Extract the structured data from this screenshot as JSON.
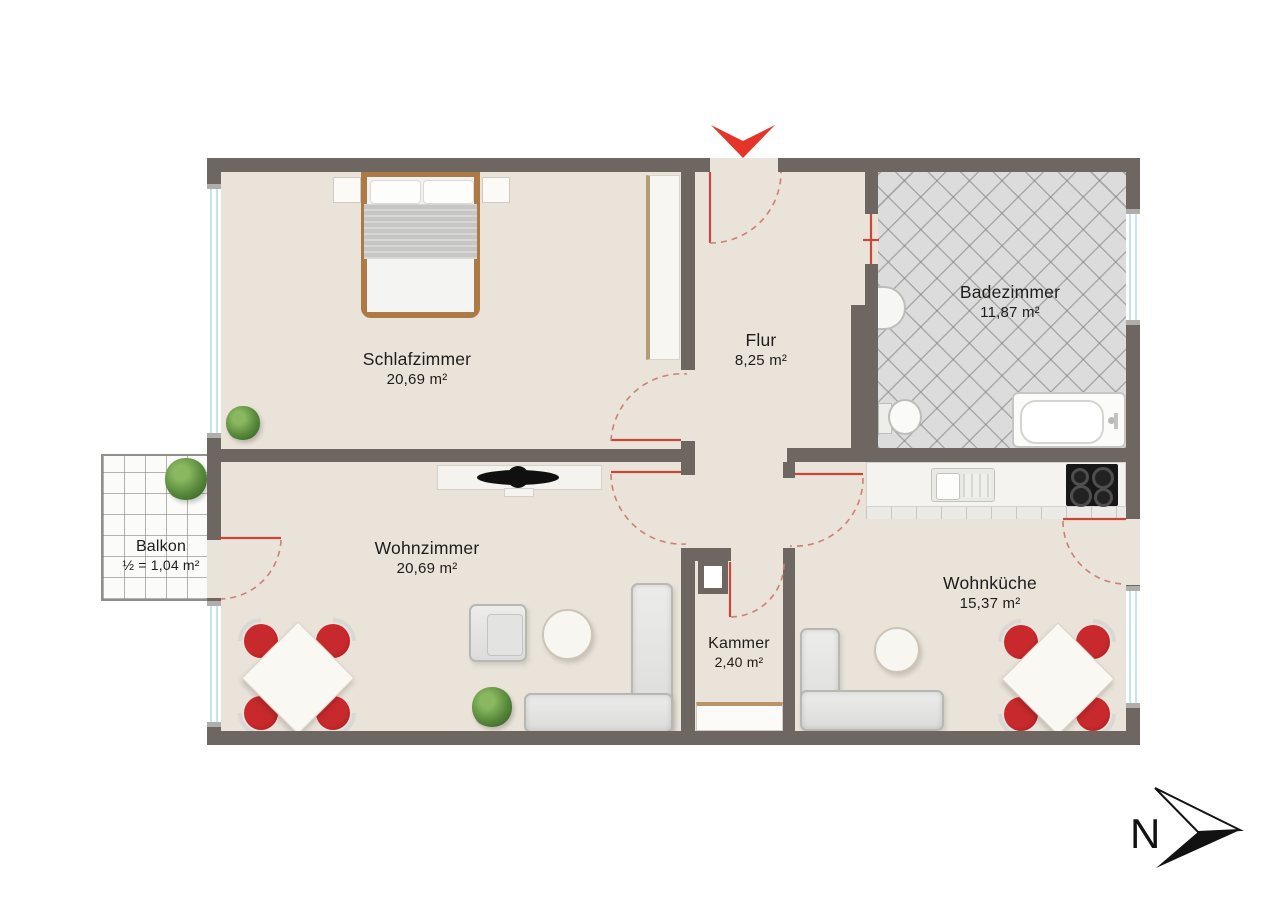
{
  "rooms": {
    "schlafzimmer": {
      "name": "Schlafzimmer",
      "area": "20,69 m²"
    },
    "flur": {
      "name": "Flur",
      "area": "8,25 m²"
    },
    "badezimmer": {
      "name": "Badezimmer",
      "area": "11,87 m²"
    },
    "wohnzimmer": {
      "name": "Wohnzimmer",
      "area": "20,69 m²"
    },
    "balkon": {
      "name": "Balkon",
      "area": "½ = 1,04 m²"
    },
    "kammer": {
      "name": "Kammer",
      "area": "2,40 m²"
    },
    "wohnkueche": {
      "name": "Wohnküche",
      "area": "15,37 m²"
    }
  },
  "compass": {
    "label": "N"
  },
  "colors": {
    "wall": "#6e6761",
    "floor": "#eae3d9",
    "bath_tile": "#dcdcdc",
    "glass": "#c2e6ea",
    "door_red": "#c8473a",
    "arc_red": "#cd7f73",
    "arrow_red": "#e5352b",
    "wood": "#ad7a45",
    "chair_red": "#b5232a",
    "text": "#1d1d1b"
  }
}
